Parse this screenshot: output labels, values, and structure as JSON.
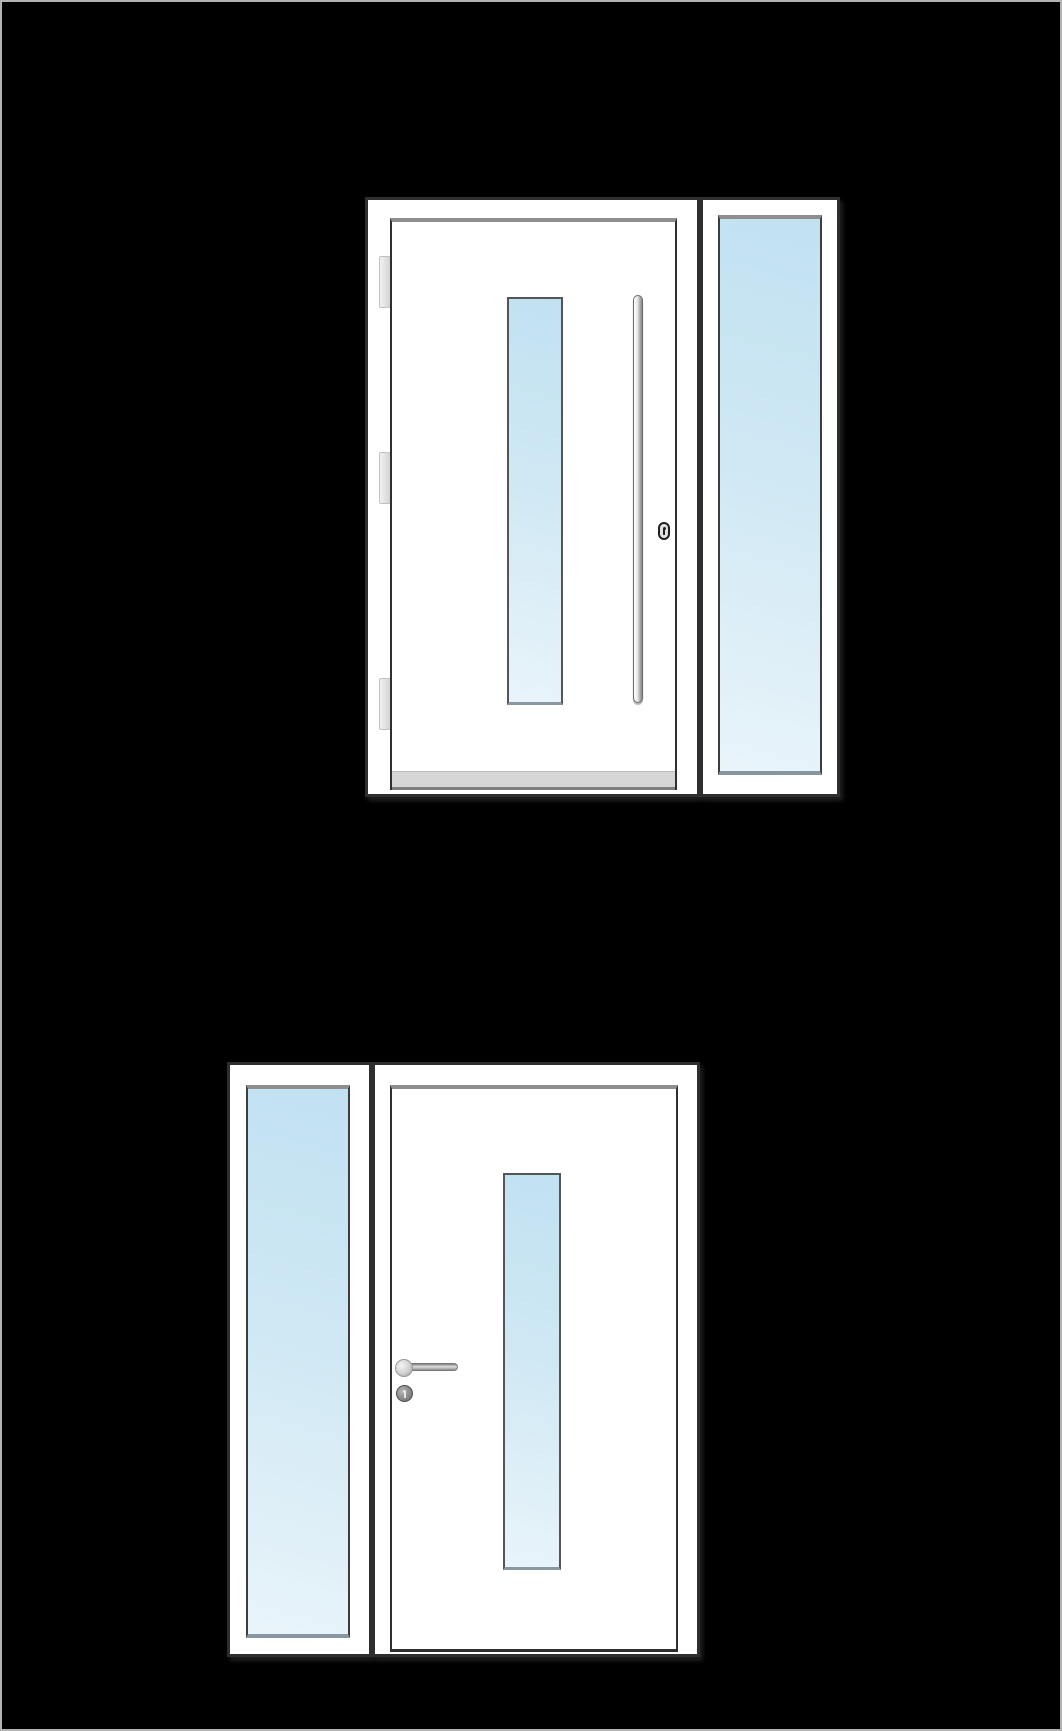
{
  "canvas": {
    "background_color": "#000000",
    "outer_border_color": "#b3b3b3"
  },
  "palette": {
    "unit_fill": "#ffffff",
    "unit_outline": "#2e2e2e",
    "inner_shadow": "#8e8e8e",
    "glass_start": "#c1e1f1",
    "glass_end": "#e9f4fa",
    "metal_light": "#f6f6f6",
    "metal_dark": "#8a8a8a",
    "threshold": "#d5d5d5",
    "hinge": "#e0e0e0"
  },
  "figures": [
    {
      "name": "entry-door-with-right-sidelight-exterior",
      "view": "exterior",
      "sidelight_position": "right",
      "door": {
        "glass_panels": 1,
        "glass_shape": "narrow-vertical",
        "handle": "vertical-bar-pull",
        "lock": "oval-keyhole-escutcheon",
        "hinge_count": 3,
        "threshold": true
      },
      "sidelight": {
        "glass_shape": "full-height"
      }
    },
    {
      "name": "entry-door-with-left-sidelight-interior",
      "view": "interior",
      "sidelight_position": "left",
      "door": {
        "glass_panels": 1,
        "glass_shape": "narrow-vertical",
        "handle": "lever-handle",
        "lock": "round-cylinder-escutcheon",
        "hinge_count": 0,
        "threshold": false
      },
      "sidelight": {
        "glass_shape": "full-height"
      }
    }
  ]
}
